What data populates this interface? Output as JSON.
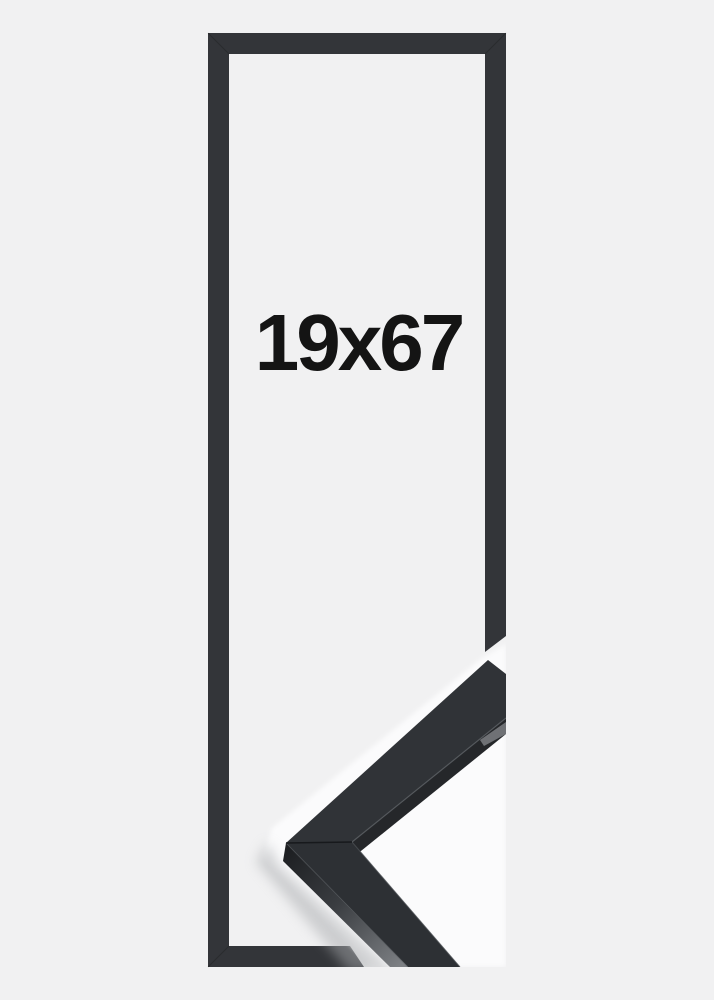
{
  "frame": {
    "size_label": "19x67"
  },
  "colors": {
    "background": "#f1f1f2",
    "frame_outline": "#333539",
    "molding_top": "#303337",
    "molding_lower": "#2d3034",
    "molding_dark": "#25272a",
    "photo_backdrop": "#fbfbfc",
    "label_text": "#141414"
  }
}
